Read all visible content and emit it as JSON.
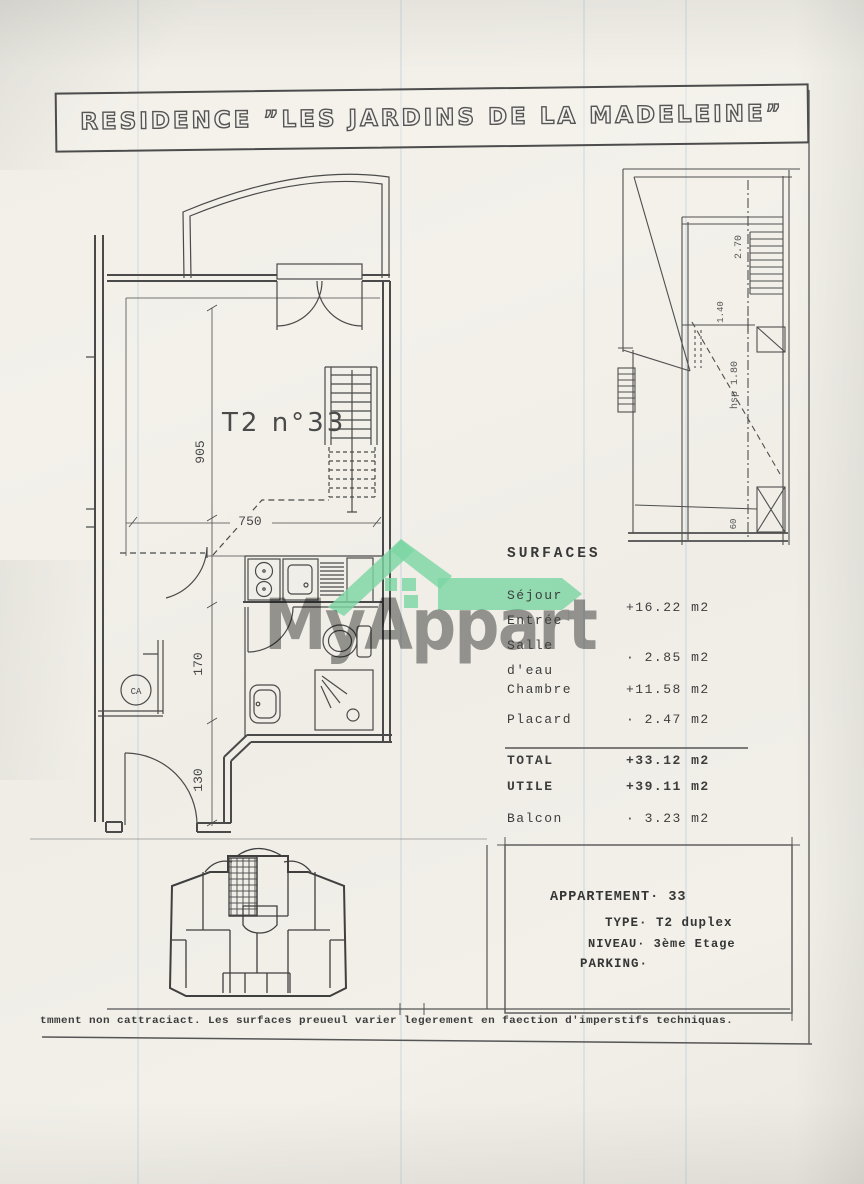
{
  "document": {
    "title": "RESIDENCE ”LES JARDINS DE LA MADELEINE”",
    "footer": "tmment non cattraciact. Les surfaces preueul varier legerement en faection d'imperstifs techniquas."
  },
  "watermark": {
    "brand": "MyAppart",
    "roof_green": "#7cd6a3",
    "text_gray": "#808080"
  },
  "main_plan": {
    "unit": "T2 n°33",
    "water_heater": "CA",
    "dims": {
      "h905": "905",
      "w750": "750",
      "d170": "170",
      "d130": "130"
    }
  },
  "upper_plan": {
    "dims": {
      "a": "2.70",
      "b": "1.40",
      "c": "hsp 1.80",
      "d": "60"
    }
  },
  "surfaces": {
    "heading": "SURFACES",
    "rows": [
      {
        "l1": "Séjour",
        "l2": "Entrée",
        "value": "+16.22 m2"
      },
      {
        "l1": "Salle",
        "l2": "d'eau",
        "value": "· 2.85 m2"
      },
      {
        "l1": "Chambre",
        "l2": "",
        "value": "+11.58 m2"
      },
      {
        "l1": "Placard",
        "l2": "",
        "value": "· 2.47 m2"
      }
    ],
    "totals": [
      {
        "label": "TOTAL",
        "value": "+33.12 m2"
      },
      {
        "label": "UTILE",
        "value": "+39.11 m2"
      },
      {
        "label": "Balcon",
        "value": "· 3.23 m2"
      }
    ]
  },
  "apartment_info": {
    "rows": [
      {
        "label": "APPARTEMENT·",
        "value": "33"
      },
      {
        "label": "TYPE·",
        "value": "T2 duplex"
      },
      {
        "label": "NIVEAU·",
        "value": "3ème Etage"
      },
      {
        "label": "PARKING·",
        "value": ""
      }
    ]
  }
}
